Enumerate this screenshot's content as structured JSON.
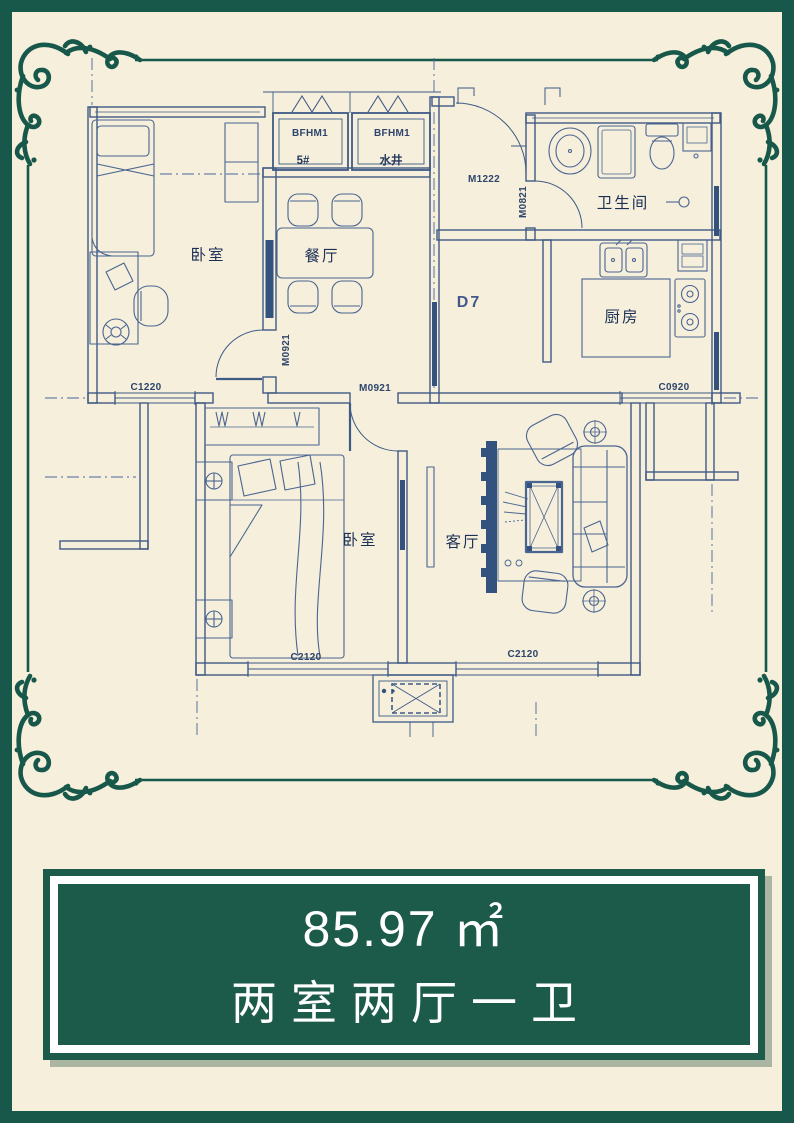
{
  "colors": {
    "background": "#f5efdc",
    "frame_green": "#17584a",
    "box_green": "#1c5a4a",
    "blueprint_line": "#3f5a85",
    "blueprint_dark": "#33527e",
    "label_navy": "#1c2f55",
    "white": "#ffffff"
  },
  "plan": {
    "rooms": {
      "bedroom_top": "卧室",
      "dining": "餐厅",
      "bathroom": "卫生间",
      "kitchen": "厨房",
      "bedroom_bottom": "卧室",
      "living": "客厅"
    },
    "shafts": {
      "left_label": "BFHM1",
      "left_name": "5#",
      "right_label": "BFHM1",
      "right_name": "水井"
    },
    "doors": {
      "entry": "M1222",
      "bathroom": "M0821",
      "bedroom_top": "M0921",
      "bedroom_bottom": "M0921"
    },
    "corridor_label": "D7",
    "windows": {
      "left": "C1220",
      "kitchen": "C0920",
      "bedroom_bottom": "C2120",
      "living": "C2120"
    }
  },
  "info_box": {
    "area": "85.97 ㎡",
    "layout": "两室两厅一卫"
  }
}
